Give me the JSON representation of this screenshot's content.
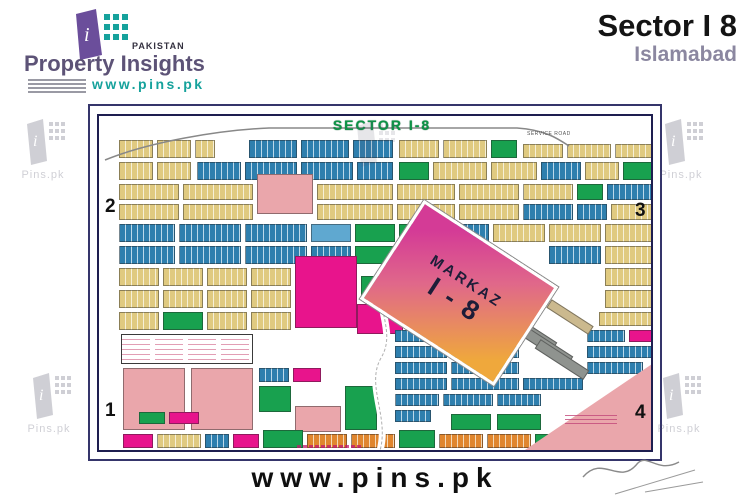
{
  "header": {
    "brand": {
      "tagline": "PAKISTAN",
      "name": "Property Insights",
      "url": "www.pins.pk"
    },
    "title": "Sector I 8",
    "subtitle": "Islamabad"
  },
  "footer": {
    "url": "www.pins.pk"
  },
  "watermark_label": "Pins.pk",
  "map": {
    "title": "SECTOR I-8",
    "corners": {
      "tl": "2",
      "tr": "3",
      "bl": "1",
      "br": "4"
    },
    "markaz": {
      "line1": "MARKAZ",
      "line2": "I - 8"
    },
    "labels": {
      "service_road": "SERVICE ROAD"
    },
    "palette": {
      "Y": "#e0ca80",
      "B": "#2e7fae",
      "G": "#18a14f",
      "M": "#e8148c",
      "P": "#eaa6ab",
      "O": "#e0862e",
      "LB": "#5fa8d0",
      "GR": "#8f938f",
      "TA": "#cbb98e",
      "W": "#ffffff"
    },
    "blocks": [
      [
        20,
        24,
        34,
        18,
        "Y"
      ],
      [
        58,
        24,
        34,
        18,
        "Y"
      ],
      [
        96,
        24,
        20,
        18,
        "Y"
      ],
      [
        150,
        24,
        48,
        18,
        "B"
      ],
      [
        202,
        24,
        48,
        18,
        "B"
      ],
      [
        254,
        24,
        40,
        18,
        "B"
      ],
      [
        300,
        24,
        40,
        18,
        "Y"
      ],
      [
        344,
        24,
        44,
        18,
        "Y"
      ],
      [
        392,
        24,
        26,
        18,
        "G"
      ],
      [
        424,
        28,
        40,
        14,
        "Y"
      ],
      [
        468,
        28,
        44,
        14,
        "Y"
      ],
      [
        516,
        28,
        38,
        14,
        "Y"
      ],
      [
        20,
        46,
        34,
        18,
        "Y"
      ],
      [
        58,
        46,
        34,
        18,
        "Y"
      ],
      [
        98,
        46,
        44,
        18,
        "B"
      ],
      [
        146,
        46,
        52,
        18,
        "B"
      ],
      [
        202,
        46,
        52,
        18,
        "B"
      ],
      [
        258,
        46,
        36,
        18,
        "B"
      ],
      [
        300,
        46,
        30,
        18,
        "G"
      ],
      [
        334,
        46,
        54,
        18,
        "Y"
      ],
      [
        392,
        46,
        46,
        18,
        "Y"
      ],
      [
        442,
        46,
        40,
        18,
        "B"
      ],
      [
        486,
        46,
        34,
        18,
        "Y"
      ],
      [
        524,
        46,
        30,
        18,
        "G"
      ],
      [
        20,
        68,
        60,
        16,
        "Y"
      ],
      [
        84,
        68,
        70,
        16,
        "Y"
      ],
      [
        158,
        58,
        56,
        40,
        "P"
      ],
      [
        218,
        68,
        76,
        16,
        "Y"
      ],
      [
        298,
        68,
        58,
        16,
        "Y"
      ],
      [
        360,
        68,
        60,
        16,
        "Y"
      ],
      [
        424,
        68,
        50,
        16,
        "Y"
      ],
      [
        478,
        68,
        26,
        16,
        "G"
      ],
      [
        508,
        68,
        46,
        16,
        "B"
      ],
      [
        20,
        88,
        60,
        16,
        "Y"
      ],
      [
        84,
        88,
        70,
        16,
        "Y"
      ],
      [
        218,
        88,
        76,
        16,
        "Y"
      ],
      [
        298,
        88,
        58,
        16,
        "Y"
      ],
      [
        360,
        88,
        60,
        16,
        "Y"
      ],
      [
        424,
        88,
        50,
        16,
        "B"
      ],
      [
        478,
        88,
        30,
        16,
        "B"
      ],
      [
        512,
        88,
        42,
        16,
        "Y"
      ],
      [
        20,
        108,
        56,
        18,
        "B"
      ],
      [
        80,
        108,
        62,
        18,
        "B"
      ],
      [
        146,
        108,
        62,
        18,
        "B"
      ],
      [
        212,
        108,
        40,
        18,
        "LB"
      ],
      [
        256,
        108,
        40,
        18,
        "G"
      ],
      [
        300,
        108,
        40,
        18,
        "G"
      ],
      [
        344,
        108,
        46,
        18,
        "B"
      ],
      [
        394,
        108,
        52,
        18,
        "Y"
      ],
      [
        450,
        108,
        52,
        18,
        "Y"
      ],
      [
        506,
        108,
        48,
        18,
        "Y"
      ],
      [
        20,
        130,
        56,
        18,
        "B"
      ],
      [
        80,
        130,
        62,
        18,
        "B"
      ],
      [
        146,
        130,
        62,
        18,
        "B"
      ],
      [
        212,
        130,
        40,
        18,
        "B"
      ],
      [
        256,
        130,
        40,
        18,
        "G"
      ],
      [
        300,
        130,
        40,
        18,
        "B"
      ],
      [
        450,
        130,
        52,
        18,
        "B"
      ],
      [
        506,
        130,
        48,
        18,
        "Y"
      ],
      [
        20,
        152,
        40,
        18,
        "Y"
      ],
      [
        64,
        152,
        40,
        18,
        "Y"
      ],
      [
        108,
        152,
        40,
        18,
        "Y"
      ],
      [
        152,
        152,
        40,
        18,
        "Y"
      ],
      [
        196,
        140,
        62,
        72,
        "M"
      ],
      [
        258,
        188,
        46,
        30,
        "M"
      ],
      [
        262,
        160,
        34,
        24,
        "G"
      ],
      [
        506,
        152,
        48,
        18,
        "Y"
      ],
      [
        20,
        174,
        40,
        18,
        "Y"
      ],
      [
        64,
        174,
        40,
        18,
        "Y"
      ],
      [
        108,
        174,
        40,
        18,
        "Y"
      ],
      [
        152,
        174,
        40,
        18,
        "Y"
      ],
      [
        506,
        174,
        48,
        18,
        "Y"
      ],
      [
        20,
        196,
        40,
        18,
        "Y"
      ],
      [
        64,
        196,
        40,
        18,
        "G"
      ],
      [
        108,
        196,
        40,
        18,
        "Y"
      ],
      [
        152,
        196,
        40,
        18,
        "Y"
      ],
      [
        500,
        196,
        54,
        14,
        "Y"
      ],
      [
        24,
        252,
        62,
        62,
        "P"
      ],
      [
        92,
        252,
        62,
        62,
        "P"
      ],
      [
        160,
        252,
        30,
        14,
        "B"
      ],
      [
        194,
        252,
        28,
        14,
        "M"
      ],
      [
        160,
        270,
        32,
        26,
        "G"
      ],
      [
        196,
        290,
        46,
        26,
        "P"
      ],
      [
        246,
        270,
        32,
        44,
        "G"
      ],
      [
        40,
        296,
        26,
        12,
        "G"
      ],
      [
        70,
        296,
        30,
        12,
        "M"
      ],
      [
        24,
        318,
        30,
        14,
        "M"
      ],
      [
        58,
        318,
        44,
        14,
        "Y"
      ],
      [
        106,
        318,
        24,
        14,
        "B"
      ],
      [
        134,
        318,
        26,
        14,
        "M"
      ],
      [
        164,
        314,
        40,
        18,
        "G"
      ],
      [
        208,
        318,
        40,
        14,
        "O"
      ],
      [
        252,
        318,
        44,
        14,
        "O"
      ],
      [
        300,
        314,
        36,
        18,
        "G"
      ],
      [
        340,
        318,
        44,
        14,
        "O"
      ],
      [
        388,
        318,
        44,
        14,
        "O"
      ],
      [
        436,
        318,
        34,
        14,
        "G"
      ],
      [
        296,
        214,
        52,
        12,
        "B"
      ],
      [
        352,
        214,
        68,
        12,
        "B"
      ],
      [
        488,
        214,
        38,
        12,
        "B"
      ],
      [
        530,
        214,
        24,
        12,
        "M"
      ],
      [
        296,
        230,
        52,
        12,
        "B"
      ],
      [
        352,
        230,
        68,
        12,
        "B"
      ],
      [
        488,
        230,
        66,
        12,
        "B"
      ],
      [
        296,
        246,
        52,
        12,
        "B"
      ],
      [
        352,
        246,
        68,
        12,
        "B"
      ],
      [
        488,
        246,
        56,
        12,
        "B"
      ],
      [
        296,
        262,
        52,
        12,
        "B"
      ],
      [
        352,
        262,
        68,
        12,
        "B"
      ],
      [
        424,
        262,
        60,
        12,
        "B"
      ],
      [
        296,
        278,
        44,
        12,
        "B"
      ],
      [
        344,
        278,
        50,
        12,
        "B"
      ],
      [
        398,
        278,
        44,
        12,
        "B"
      ],
      [
        296,
        294,
        36,
        12,
        "B"
      ],
      [
        352,
        298,
        40,
        16,
        "G"
      ],
      [
        398,
        298,
        44,
        16,
        "G"
      ],
      [
        446,
        196,
        50,
        10,
        "TA",
        33
      ],
      [
        402,
        210,
        58,
        11,
        "GR",
        33
      ],
      [
        418,
        224,
        58,
        11,
        "GR",
        33
      ],
      [
        434,
        238,
        58,
        11,
        "GR",
        33
      ]
    ]
  }
}
